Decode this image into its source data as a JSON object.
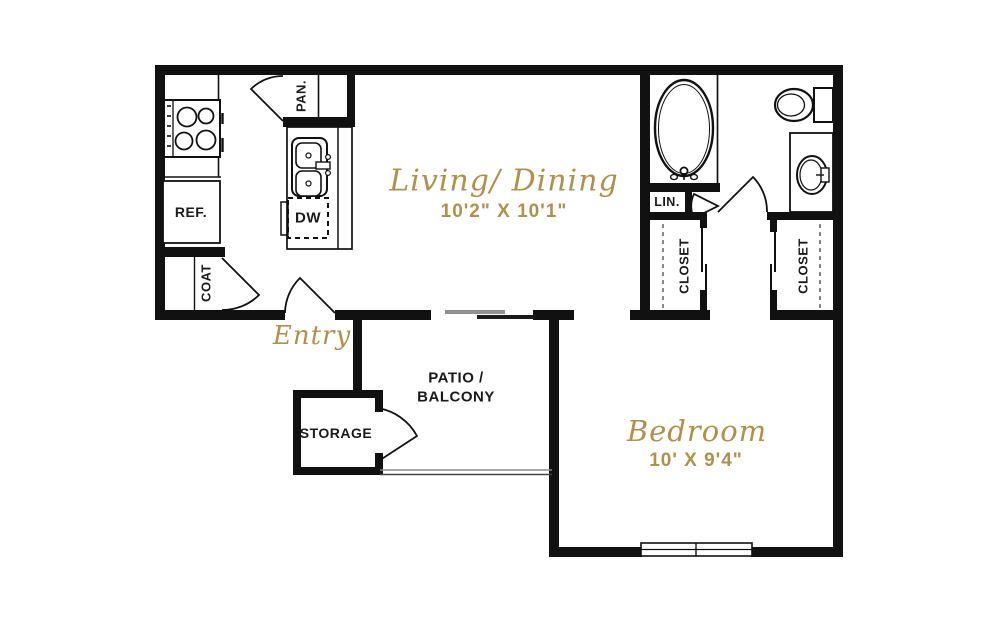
{
  "plan_title": "One Bedroom Apartment Floor Plan",
  "colors": {
    "wall": "#111111",
    "accent_gold": "#b1904a",
    "background": "#ffffff",
    "railing_gray": "#8a8a8a"
  },
  "rooms": {
    "living_dining": {
      "label": "Living/ Dining",
      "dimensions": "10'2\" X 10'1\""
    },
    "bedroom": {
      "label": "Bedroom",
      "dimensions": "10' X 9'4\""
    },
    "entry": {
      "label": "Entry"
    },
    "patio": {
      "label_line1": "PATIO /",
      "label_line2": "BALCONY"
    },
    "storage": {
      "label": "STORAGE"
    },
    "pantry": {
      "label": "PAN."
    },
    "coat_closet": {
      "label": "COAT"
    },
    "linen_closet": {
      "label": "LIN."
    },
    "closet_left": {
      "label": "CLOSET"
    },
    "closet_right": {
      "label": "CLOSET"
    }
  },
  "appliances": {
    "refrigerator": "REF.",
    "dishwasher": "DW"
  },
  "fixture_icons": {
    "stove-icon": "four-burner-cooktop-circles",
    "kitchen-sink-icon": "double-basin-rounded-rects",
    "bathtub-icon": "oval-tub-with-faucet",
    "toilet-icon": "oval-bowl-with-tank",
    "bathroom-sink-icon": "oval-basin-in-vanity",
    "window-icon": "double-line-window",
    "sliding-door-icon": "offset-parallel-lines",
    "railing-icon": "double-thin-line",
    "door-swing-icon": "quarter-arc-with-leaf",
    "closet-rod-icon": "dashed-line"
  }
}
